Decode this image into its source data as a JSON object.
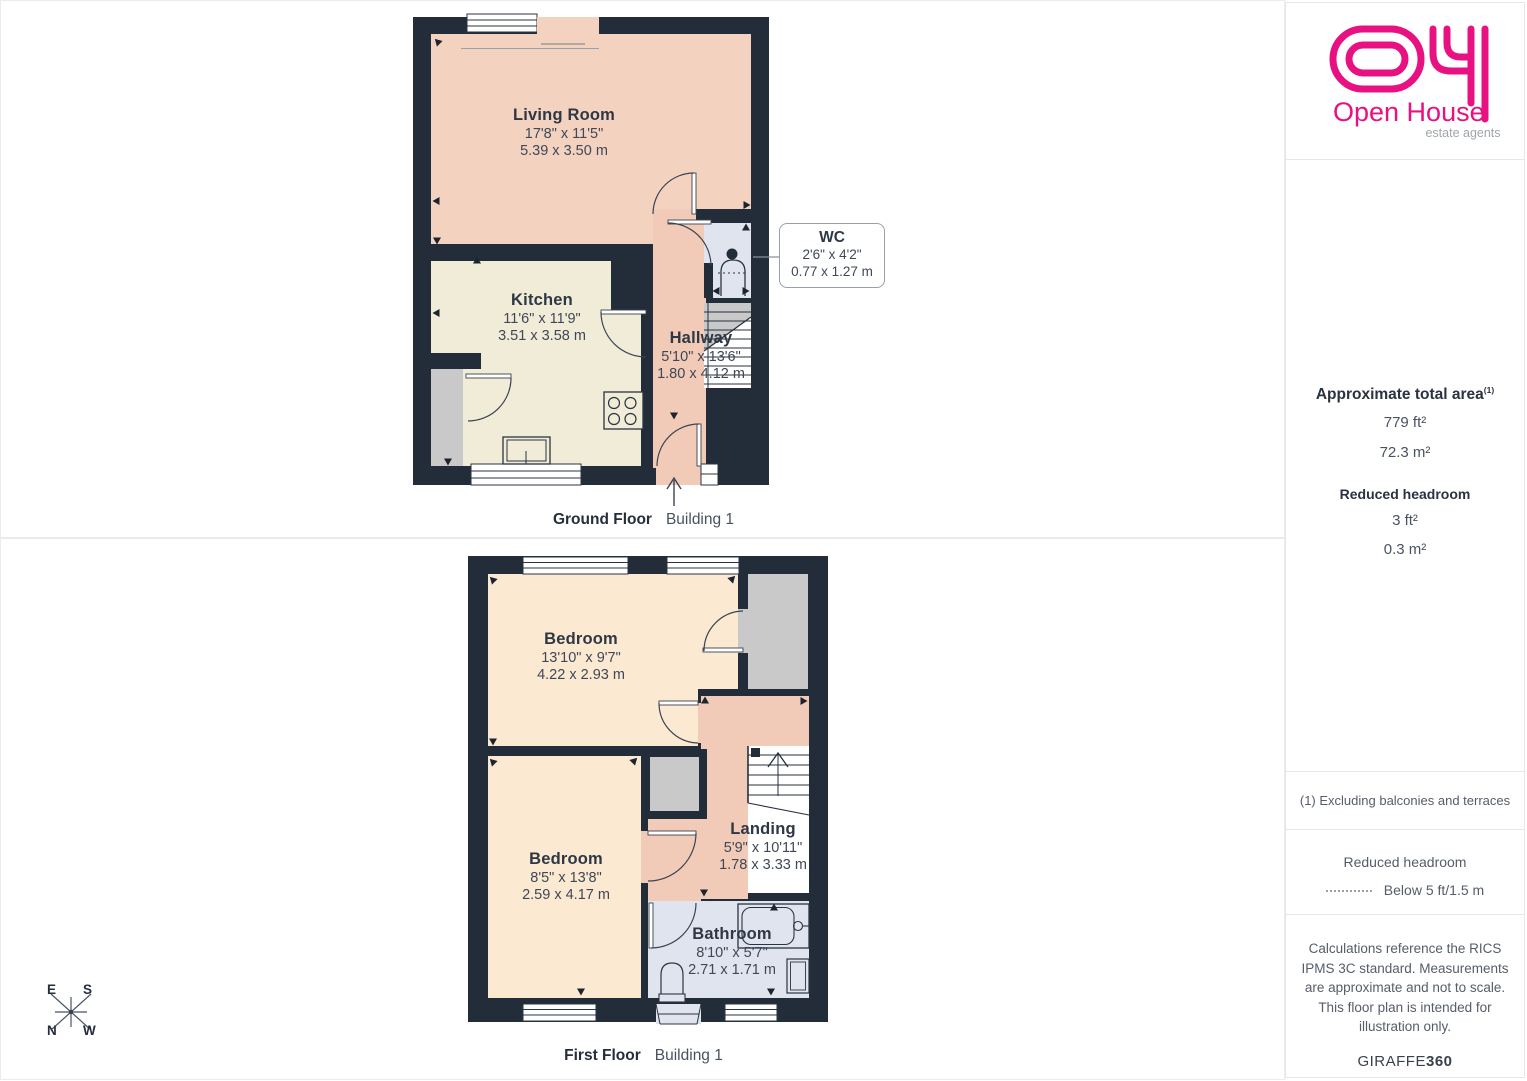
{
  "brand": {
    "name": "Open House",
    "tagline": "estate agents",
    "pink": "#e81181"
  },
  "floors": [
    {
      "caption_bold": "Ground Floor",
      "caption_normal": "Building 1",
      "rooms": [
        {
          "name": "Living Room",
          "imperial": "17'8\" x 11'5\"",
          "metric": "5.39 x 3.50 m"
        },
        {
          "name": "Kitchen",
          "imperial": "11'6\" x 11'9\"",
          "metric": "3.51 x 3.58 m"
        },
        {
          "name": "Hallway",
          "imperial": "5'10\" x 13'6\"",
          "metric": "1.80 x 4.12 m"
        },
        {
          "name": "WC",
          "imperial": "2'6\" x 4'2\"",
          "metric": "0.77 x 1.27 m"
        }
      ]
    },
    {
      "caption_bold": "First Floor",
      "caption_normal": "Building 1",
      "rooms": [
        {
          "name": "Bedroom",
          "imperial": "13'10\" x 9'7\"",
          "metric": "4.22 x 2.93 m"
        },
        {
          "name": "Bedroom",
          "imperial": "8'5\" x 13'8\"",
          "metric": "2.59 x 4.17 m"
        },
        {
          "name": "Landing",
          "imperial": "5'9\" x 10'11\"",
          "metric": "1.78 x 3.33 m"
        },
        {
          "name": "Bathroom",
          "imperial": "8'10\" x 5'7\"",
          "metric": "2.71 x 1.71 m"
        }
      ]
    }
  ],
  "sidebar": {
    "area_title": "Approximate total area",
    "area_sup": "(1)",
    "area_ft": "779 ft²",
    "area_m": "72.3 m²",
    "rh_title": "Reduced headroom",
    "rh_ft": "3 ft²",
    "rh_m": "0.3 m²",
    "footnote": "(1) Excluding balconies and terraces",
    "legend_title": "Reduced headroom",
    "legend_label": "Below 5 ft/1.5 m",
    "disclaimer": "Calculations reference the RICS IPMS 3C standard. Measurements are approximate and not to scale. This floor plan is intended for illustration only.",
    "brand_normal": "GIRAFFE",
    "brand_bold": "360"
  },
  "compass": {
    "n": "N",
    "e": "E",
    "s": "S",
    "w": "W"
  },
  "colors": {
    "wall": "#232d3a",
    "living_peach": "#f4d2c0",
    "hallway_peach": "#f1cbb7",
    "kitchen_cream": "#f1ecd7",
    "bedroom_peach": "#fce9d1",
    "bath_blue": "#dfe4ef",
    "fixture_gray": "#c9c9ca",
    "brand_pink": "#e81181"
  }
}
